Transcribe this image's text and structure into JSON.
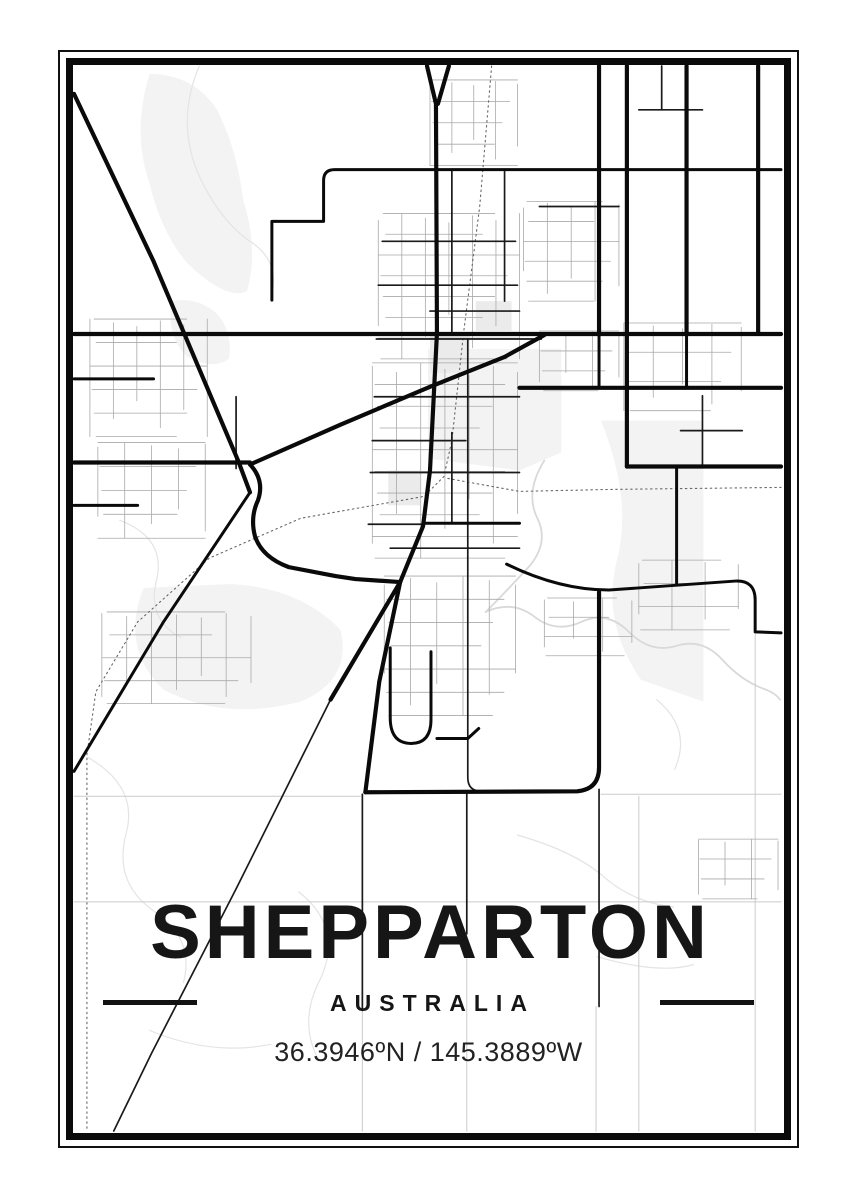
{
  "poster": {
    "title": "SHEPPARTON",
    "country": "AUSTRALIA",
    "coordinates": "36.3946ºN / 145.3889ºW",
    "colors": {
      "background": "#ffffff",
      "ink": "#0a0a0a",
      "frame": "#0b0b0b",
      "minor_road": "#a9a9a9",
      "faint_road": "#cbcbcb",
      "contour": "#e4e4e4",
      "river": "#d9d9d9",
      "land_fill": "#f3f3f3"
    }
  },
  "map": {
    "viewBox": "71 63 715 1072",
    "layers": [
      {
        "name": "land-fills",
        "fill": "#f3f3f3",
        "paths": [
          "M148,72 Q130,130 148,182 Q160,232 186,262 Q226,300 246,290 Q258,248 242,198 Q236,148 216,108 Q192,72 148,72 Z",
          "M170,300 Q165,335 185,355 Q210,370 228,358 Q232,330 215,312 Q195,295 170,300 Z",
          "M428,348 L562,348 L562,452 L520,470 L428,458 Z",
          "M142,588 Q118,648 162,690 Q222,722 300,702 Q352,680 340,630 Q300,588 230,584 Z",
          "M602,420 Q634,500 618,560 Q602,622 642,680 L705,702 L705,420 Z"
        ]
      },
      {
        "name": "pale-blocks",
        "fill": "#ebebeb",
        "paths": [
          "M430,332 H470 V372 H430 Z",
          "M476,300 H512 V330 H476 Z",
          "M388,470 H420 V505 H388 Z"
        ]
      },
      {
        "name": "contour-lines",
        "stroke": "#e4e4e4",
        "width": 1.2,
        "paths": [
          "M198,64 Q175,118 196,170 Q218,220 252,242 Q280,262 270,296",
          "M118,520 Q165,538 155,580 Q145,620 180,638",
          "M86,758 Q138,788 124,836 Q112,884 152,912 Q194,940 182,984",
          "M298,893 Q345,930 318,984 Q298,1024 318,1062",
          "M518,836 Q575,852 605,878 Q635,904 675,908",
          "M598,958 Q660,976 695,966",
          "M658,700 Q694,730 676,770",
          "M148,1032 Q210,1058 270,1046"
        ]
      },
      {
        "name": "river",
        "stroke": "#d9d9d9",
        "width": 1.8,
        "paths": [
          "M545,460 Q525,492 538,518 Q550,542 530,566 Q508,590 486,612",
          "M486,612 Q512,600 534,616 Q556,634 582,622 Q608,610 630,632 Q652,654 678,646 Q704,638 724,660 Q744,682 768,690 Q778,694 782,700"
        ]
      },
      {
        "name": "faint-roads",
        "stroke": "#cbcbcb",
        "width": 1,
        "paths": [
          "M72,797 H360",
          "M602,795 H783",
          "M72,903 H783",
          "M597,1008 V1133",
          "M757,634 V1133",
          "M362,1012 V1133",
          "M467,935 V1133",
          "M640,797 V1133"
        ]
      },
      {
        "name": "minor-street-grids",
        "grid": true,
        "stroke": "#a9a9a9",
        "width": 0.8,
        "grids": [
          {
            "x": 430,
            "y": 78,
            "w": 88,
            "h": 86,
            "nx": 4,
            "ny": 4
          },
          {
            "x": 378,
            "y": 212,
            "w": 142,
            "h": 146,
            "nx": 6,
            "ny": 7
          },
          {
            "x": 372,
            "y": 362,
            "w": 146,
            "h": 196,
            "nx": 6,
            "ny": 9
          },
          {
            "x": 524,
            "y": 200,
            "w": 96,
            "h": 100,
            "nx": 4,
            "ny": 5
          },
          {
            "x": 540,
            "y": 330,
            "w": 80,
            "h": 60,
            "nx": 3,
            "ny": 3
          },
          {
            "x": 88,
            "y": 318,
            "w": 118,
            "h": 118,
            "nx": 5,
            "ny": 5
          },
          {
            "x": 96,
            "y": 442,
            "w": 108,
            "h": 96,
            "nx": 4,
            "ny": 4
          },
          {
            "x": 100,
            "y": 612,
            "w": 150,
            "h": 92,
            "nx": 6,
            "ny": 4
          },
          {
            "x": 384,
            "y": 576,
            "w": 132,
            "h": 140,
            "nx": 5,
            "ny": 6
          },
          {
            "x": 545,
            "y": 598,
            "w": 88,
            "h": 58,
            "nx": 3,
            "ny": 3
          },
          {
            "x": 625,
            "y": 322,
            "w": 118,
            "h": 88,
            "nx": 4,
            "ny": 3
          },
          {
            "x": 640,
            "y": 560,
            "w": 100,
            "h": 70,
            "nx": 3,
            "ny": 3
          },
          {
            "x": 700,
            "y": 840,
            "w": 80,
            "h": 60,
            "nx": 3,
            "ny": 3
          }
        ]
      },
      {
        "name": "railway-dotted",
        "stroke": "#666666",
        "width": 1.1,
        "dash": "1.5 3.5",
        "paths": [
          "M492,64 L480,205 L464,330 L452,440 L444,476 L424,496 L300,518 L208,558 L136,622 L94,692 L85,755 L85,1133",
          "M448,478 L520,491 L612,489 L783,487"
        ]
      },
      {
        "name": "medium-roads",
        "stroke": "#1a1a1a",
        "width": 1.7,
        "paths": [
          "M235,396 V468",
          "M382,240 H516",
          "M378,284 H518",
          "M430,310 H520",
          "M376,338 H542",
          "M374,396 H520",
          "M372,440 H466",
          "M370,472 H520",
          "M368,524 H424",
          "M390,548 H520",
          "M452,168 V332",
          "M505,170 V300",
          "M468,338 V556",
          "M452,432 V522",
          "M600,790 V1008",
          "M362,795 V1012",
          "M467,792 V935",
          "M640,108 H704",
          "M663,64 V108",
          "M682,430 H744",
          "M704,395 V464",
          "M540,205 H620",
          "M468,556 V778 Q468,792 482,792",
          "M330,700 L235,890 L150,1055 L112,1133"
        ]
      },
      {
        "name": "major-roads-secondary",
        "stroke": "#0a0a0a",
        "width": 3,
        "paths": [
          "M783,168 H334 Q323,168 323,179 V220 H271 V299",
          "M72,378 H152",
          "M72,505 H136",
          "M249,492 L162,622 L72,772",
          "M688,332 V387",
          "M678,466 V584",
          "M600,330 V387",
          "M424,523 H520",
          "M390,648 V718 Q390,744 411,744 Q431,744 431,720 V652",
          "M437,739 H468 L479,729",
          "M507,564 Q560,590 610,590 L737,581 Q757,580 757,600 V632 L783,633"
        ]
      },
      {
        "name": "major-roads",
        "stroke": "#0a0a0a",
        "width": 4.2,
        "paths": [
          "M427,64 L436,102 L437,332 L430,470 L423,526 L400,582 L379,682 L365,793",
          "M449,64 L438,102",
          "M72,333 H783",
          "M520,387 H783",
          "M628,466 H783",
          "M600,64 V332",
          "M628,64 V466",
          "M688,64 V332",
          "M760,64 V332",
          "M249,464 L340,424 L430,386 L505,356 L545,334",
          "M72,92 L152,260 L237,460 L249,492",
          "M249,464 Q264,480 257,500 Q249,517 254,536 Q261,557 288,567 L335,576 L355,579 L400,582",
          "M400,582 L330,700",
          "M600,592 V768 Q600,790 578,792 L365,793",
          "M72,462 H249"
        ]
      }
    ]
  }
}
